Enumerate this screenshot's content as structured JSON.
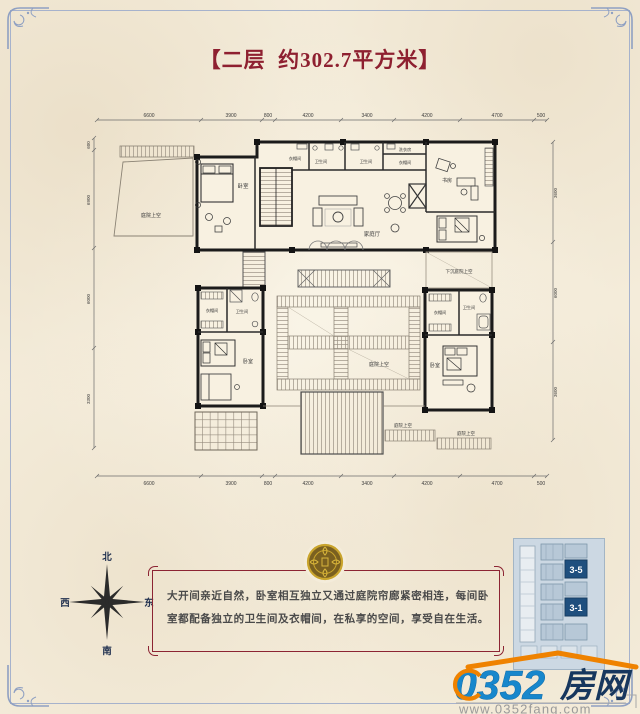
{
  "title": {
    "text": "【二层  约302.7平方米】"
  },
  "colors": {
    "title_red": "#8e2030",
    "frame_blue": "#8fa0c2",
    "desc_border_red": "#8c2433",
    "seal_gold": "#c9a42c",
    "logo_blue": "#1787cc",
    "logo_navy": "#17375e",
    "logo_orange": "#ef8200",
    "keyplan_highlight": "#1f4f7e"
  },
  "floorplan": {
    "dims_top": [
      "6600",
      "3900",
      "800",
      "4200",
      "3400",
      "4200",
      "4700",
      "500"
    ],
    "dims_bottom": [
      "6600",
      "3900",
      "800",
      "4200",
      "3400",
      "4200",
      "4700",
      "500"
    ],
    "dims_left": [
      "600",
      "6900",
      "6000",
      "3300"
    ],
    "dims_right": [
      "3600",
      "6000",
      "3600"
    ],
    "rooms": {
      "bedroom": "卧室",
      "cloakroom": "衣帽间",
      "bathroom": "卫生间",
      "family_hall": "家庭厅",
      "study": "书房",
      "laundry": "洗衣房",
      "courtyard_above": "庭院上空",
      "sunken_courtyard_above": "下沉庭院上空"
    }
  },
  "compass": {
    "north": "北",
    "south": "南",
    "east": "东",
    "west": "西"
  },
  "description": {
    "text": "大开间亲近自然，卧室相互独立又通过庭院帘廊紧密相连，每间卧室都配备独立的卫生间及衣帽间，在私享的空间，享受自在生活。"
  },
  "keyplan": {
    "unit_top": "3-5",
    "unit_bottom": "3-1"
  },
  "logo": {
    "number": "0352",
    "cn": "房网",
    "url": "www.0352fang.com"
  }
}
